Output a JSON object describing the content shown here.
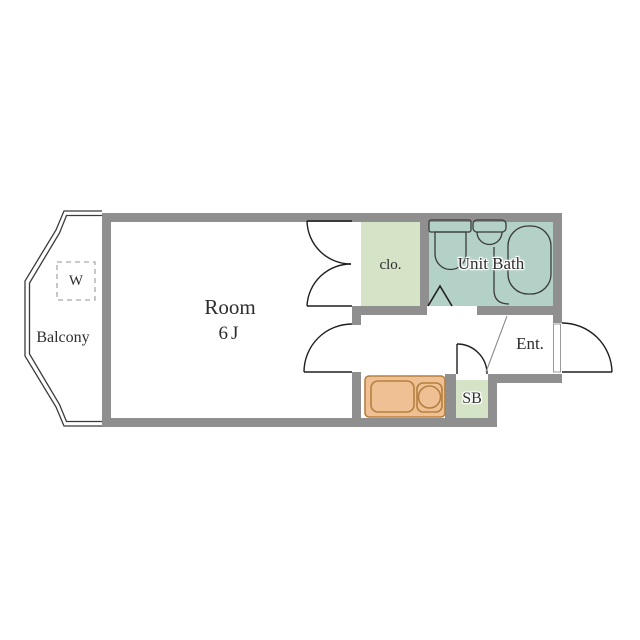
{
  "floorplan": {
    "balcony": {
      "label": "Balcony",
      "washer_label": "W"
    },
    "room": {
      "label": "Room",
      "size": "6J"
    },
    "closet": {
      "label": "clo."
    },
    "unit_bath": {
      "label": "Unit Bath"
    },
    "entrance": {
      "label": "Ent."
    },
    "shoe_box": {
      "label": "SB"
    }
  },
  "fixtures": [
    "toilet",
    "washbasin",
    "bathtub",
    "kitchen-sink",
    "stove-burner",
    "washing-machine-space"
  ],
  "colors": {
    "wall": "#8f8f8f",
    "closet_fill": "#d5e3c6",
    "bath_fill": "#b3d1c7",
    "sb_fill": "#d5e3c6",
    "kitchen_fill": "#eec094",
    "kitchen_border": "#b5803f",
    "outline": "#2e2e2e",
    "door_line": "#1f1f1f",
    "fixture_line": "#3a3a3a",
    "balcony_line": "#3a3a3a",
    "dashed_box": "#a9a9a9",
    "step_line": "#8a8a8a"
  }
}
